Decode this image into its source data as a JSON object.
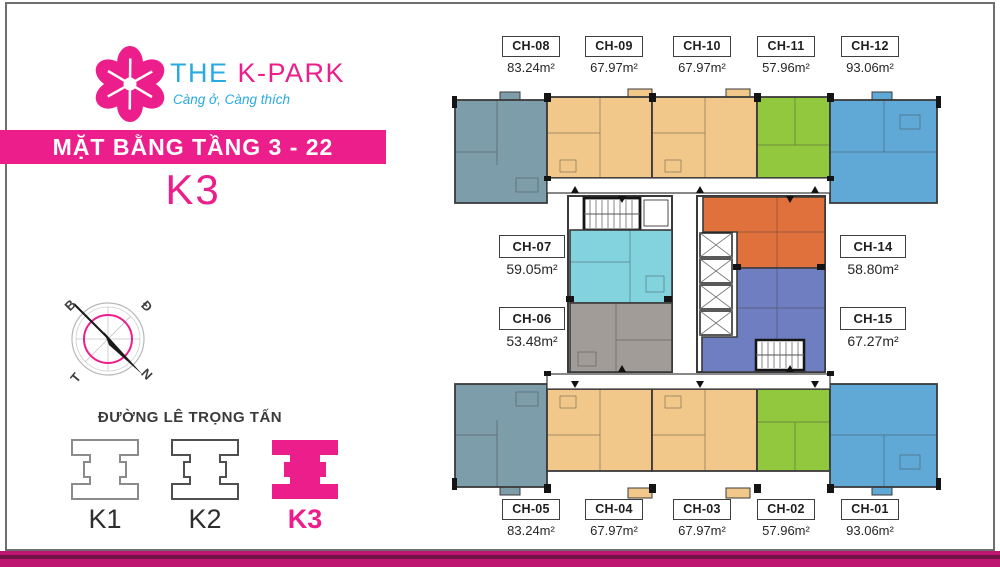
{
  "brand": {
    "the": "THE",
    "name": "K-PARK",
    "tagline": "Càng ở, Càng thích"
  },
  "header": {
    "title": "MẶT BẰNG TẦNG 3 - 22",
    "tower": "K3"
  },
  "compass": {
    "b": "B",
    "d": "Đ",
    "t": "T",
    "n": "N"
  },
  "street_label": "ĐƯỜNG LÊ TRỌNG TẤN",
  "towers": [
    {
      "label": "K1"
    },
    {
      "label": "K2"
    },
    {
      "label": "K3"
    }
  ],
  "active_tower": "K3",
  "units": {
    "top": [
      {
        "id": "CH-08",
        "area": "83.24m²"
      },
      {
        "id": "CH-09",
        "area": "67.97m²"
      },
      {
        "id": "CH-10",
        "area": "67.97m²"
      },
      {
        "id": "CH-11",
        "area": "57.96m²"
      },
      {
        "id": "CH-12",
        "area": "93.06m²"
      }
    ],
    "left": [
      {
        "id": "CH-07",
        "area": "59.05m²"
      },
      {
        "id": "CH-06",
        "area": "53.48m²"
      }
    ],
    "right": [
      {
        "id": "CH-14",
        "area": "58.80m²"
      },
      {
        "id": "CH-15",
        "area": "67.27m²"
      }
    ],
    "bottom": [
      {
        "id": "CH-05",
        "area": "83.24m²"
      },
      {
        "id": "CH-04",
        "area": "67.97m²"
      },
      {
        "id": "CH-03",
        "area": "67.97m²"
      },
      {
        "id": "CH-02",
        "area": "57.96m²"
      },
      {
        "id": "CH-01",
        "area": "93.06m²"
      }
    ]
  },
  "colors": {
    "magenta": "#EC1E8C",
    "cyan": "#29AAE1",
    "footer_pink": "#BE1570",
    "footer_dark": "#731247",
    "frame_gray": "#6E6E6E",
    "wall": "#3A3A3A",
    "unit_slate": "#7E9DAB",
    "unit_tan": "#F1C88A",
    "unit_green": "#92C83E",
    "unit_blue": "#60A9D6",
    "unit_aqua": "#82D3DE",
    "unit_gray": "#A29C98",
    "unit_orange": "#E0703C",
    "unit_purple": "#6F7EC0"
  }
}
